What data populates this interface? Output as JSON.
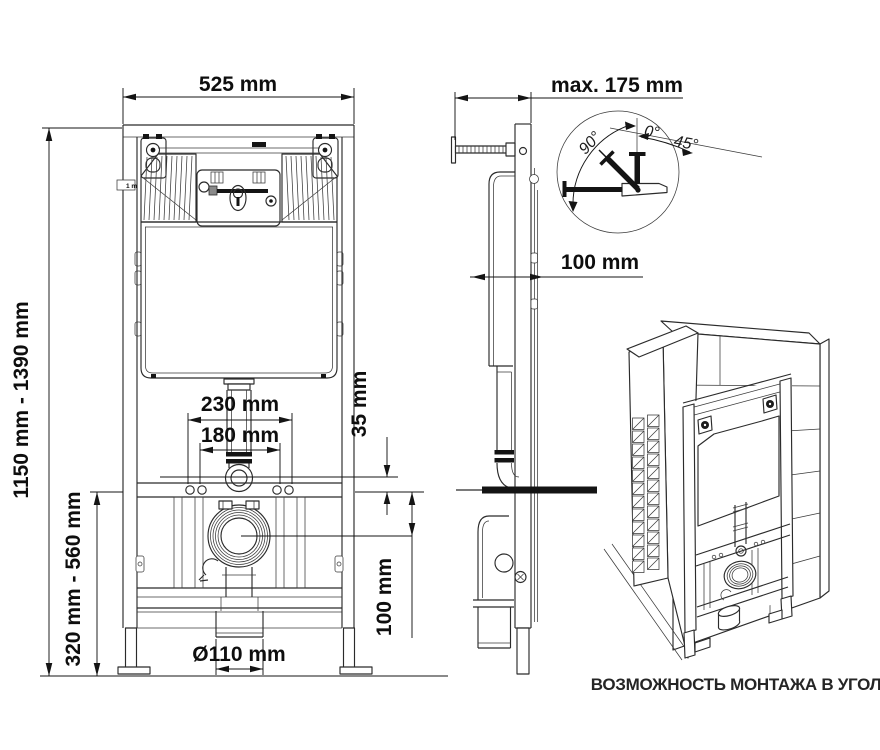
{
  "labels": {
    "front": {
      "width": "525 mm",
      "height_range": "1150 mm - 1390 mm",
      "bolt_outer": "230 mm",
      "bolt_inner": "180 mm",
      "offset_35": "35 mm",
      "offset_100": "100 mm",
      "lower_range": "320 mm - 560 mm",
      "outlet_diameter": "Ø110 mm",
      "mini": "1 m"
    },
    "side": {
      "depth_max": "max. 175 mm",
      "cistern_depth": "100 mm"
    },
    "detail": {
      "angle_90": "90°",
      "angle_0": "0°",
      "angle_45": "45°"
    },
    "corner": {
      "caption": "ВОЗМОЖНОСТЬ МОНТАЖА В УГОЛ"
    }
  },
  "colors": {
    "line": "#2b2b2b",
    "dim": "#151515",
    "background": "#ffffff"
  }
}
